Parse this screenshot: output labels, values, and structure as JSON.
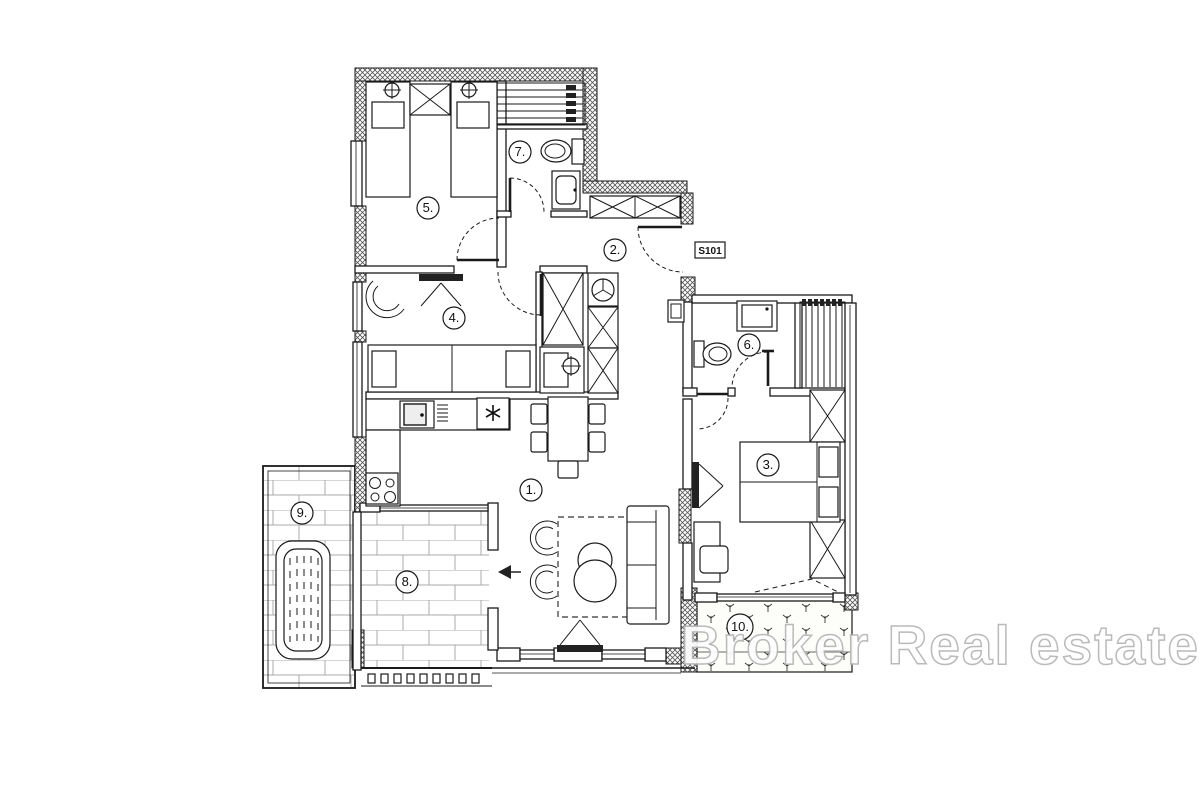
{
  "plan": {
    "watermark_text": "Broker Real estate",
    "entry_door_label": "S101",
    "rooms": [
      {
        "id": 1,
        "label": "1."
      },
      {
        "id": 2,
        "label": "2."
      },
      {
        "id": 3,
        "label": "3."
      },
      {
        "id": 4,
        "label": "4."
      },
      {
        "id": 5,
        "label": "5."
      },
      {
        "id": 6,
        "label": "6."
      },
      {
        "id": 7,
        "label": "7."
      },
      {
        "id": 8,
        "label": "8."
      },
      {
        "id": 9,
        "label": "9."
      },
      {
        "id": 10,
        "label": "10."
      }
    ]
  }
}
